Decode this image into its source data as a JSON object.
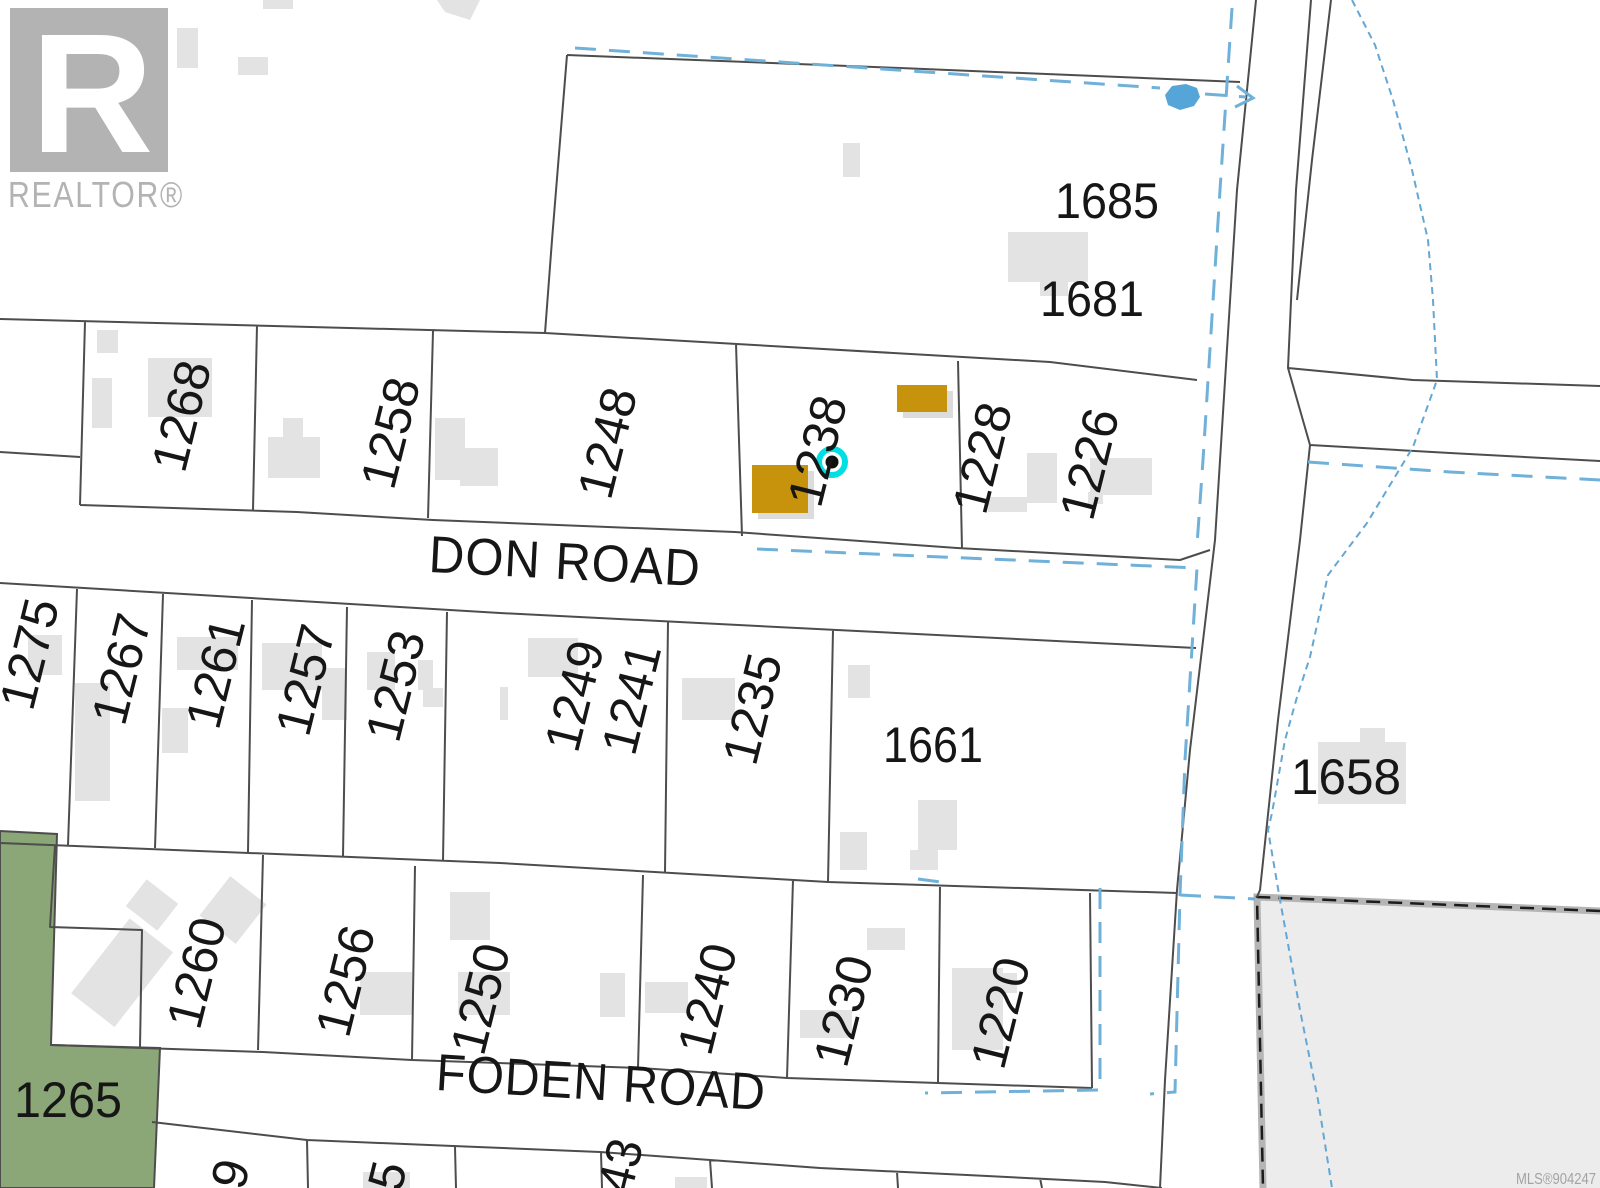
{
  "watermark": {
    "logo_letter": "R",
    "brand": "REALTOR®"
  },
  "roads": {
    "don": "DON ROAD",
    "foden": "FODEN ROAD"
  },
  "lots": {
    "1268": "1268",
    "1258": "1258",
    "1248": "1248",
    "1238": "1238",
    "1228": "1228",
    "1226": "1226",
    "1275": "1275",
    "1267": "1267",
    "1261": "1261",
    "1257": "1257",
    "1253": "1253",
    "1249": "1249",
    "1241": "1241",
    "1235": "1235",
    "1661": "1661",
    "1685": "1685",
    "1681": "1681",
    "1658": "1658",
    "1260": "1260",
    "1256": "1256",
    "1250": "1250",
    "1240": "1240",
    "1230": "1230",
    "1220": "1220",
    "1265": "1265"
  },
  "partial_lots": {
    "p9": "9",
    "p5": "5",
    "p43": "43"
  },
  "mls_number": "MLS®904247",
  "colors": {
    "highlight": "#c8930c",
    "marker_cyan": "#00dfe4",
    "marker_dot": "#101010",
    "green_space": "#8ba677",
    "park_gray": "#ececec",
    "water_blue": "#6fb1d9",
    "stream_blue": "#64a7d4",
    "parcel_line": "#4d4d4d",
    "building_gray": "#e3e3e3",
    "label_black": "#161616",
    "watermark_gray": "#b3b3b3"
  }
}
